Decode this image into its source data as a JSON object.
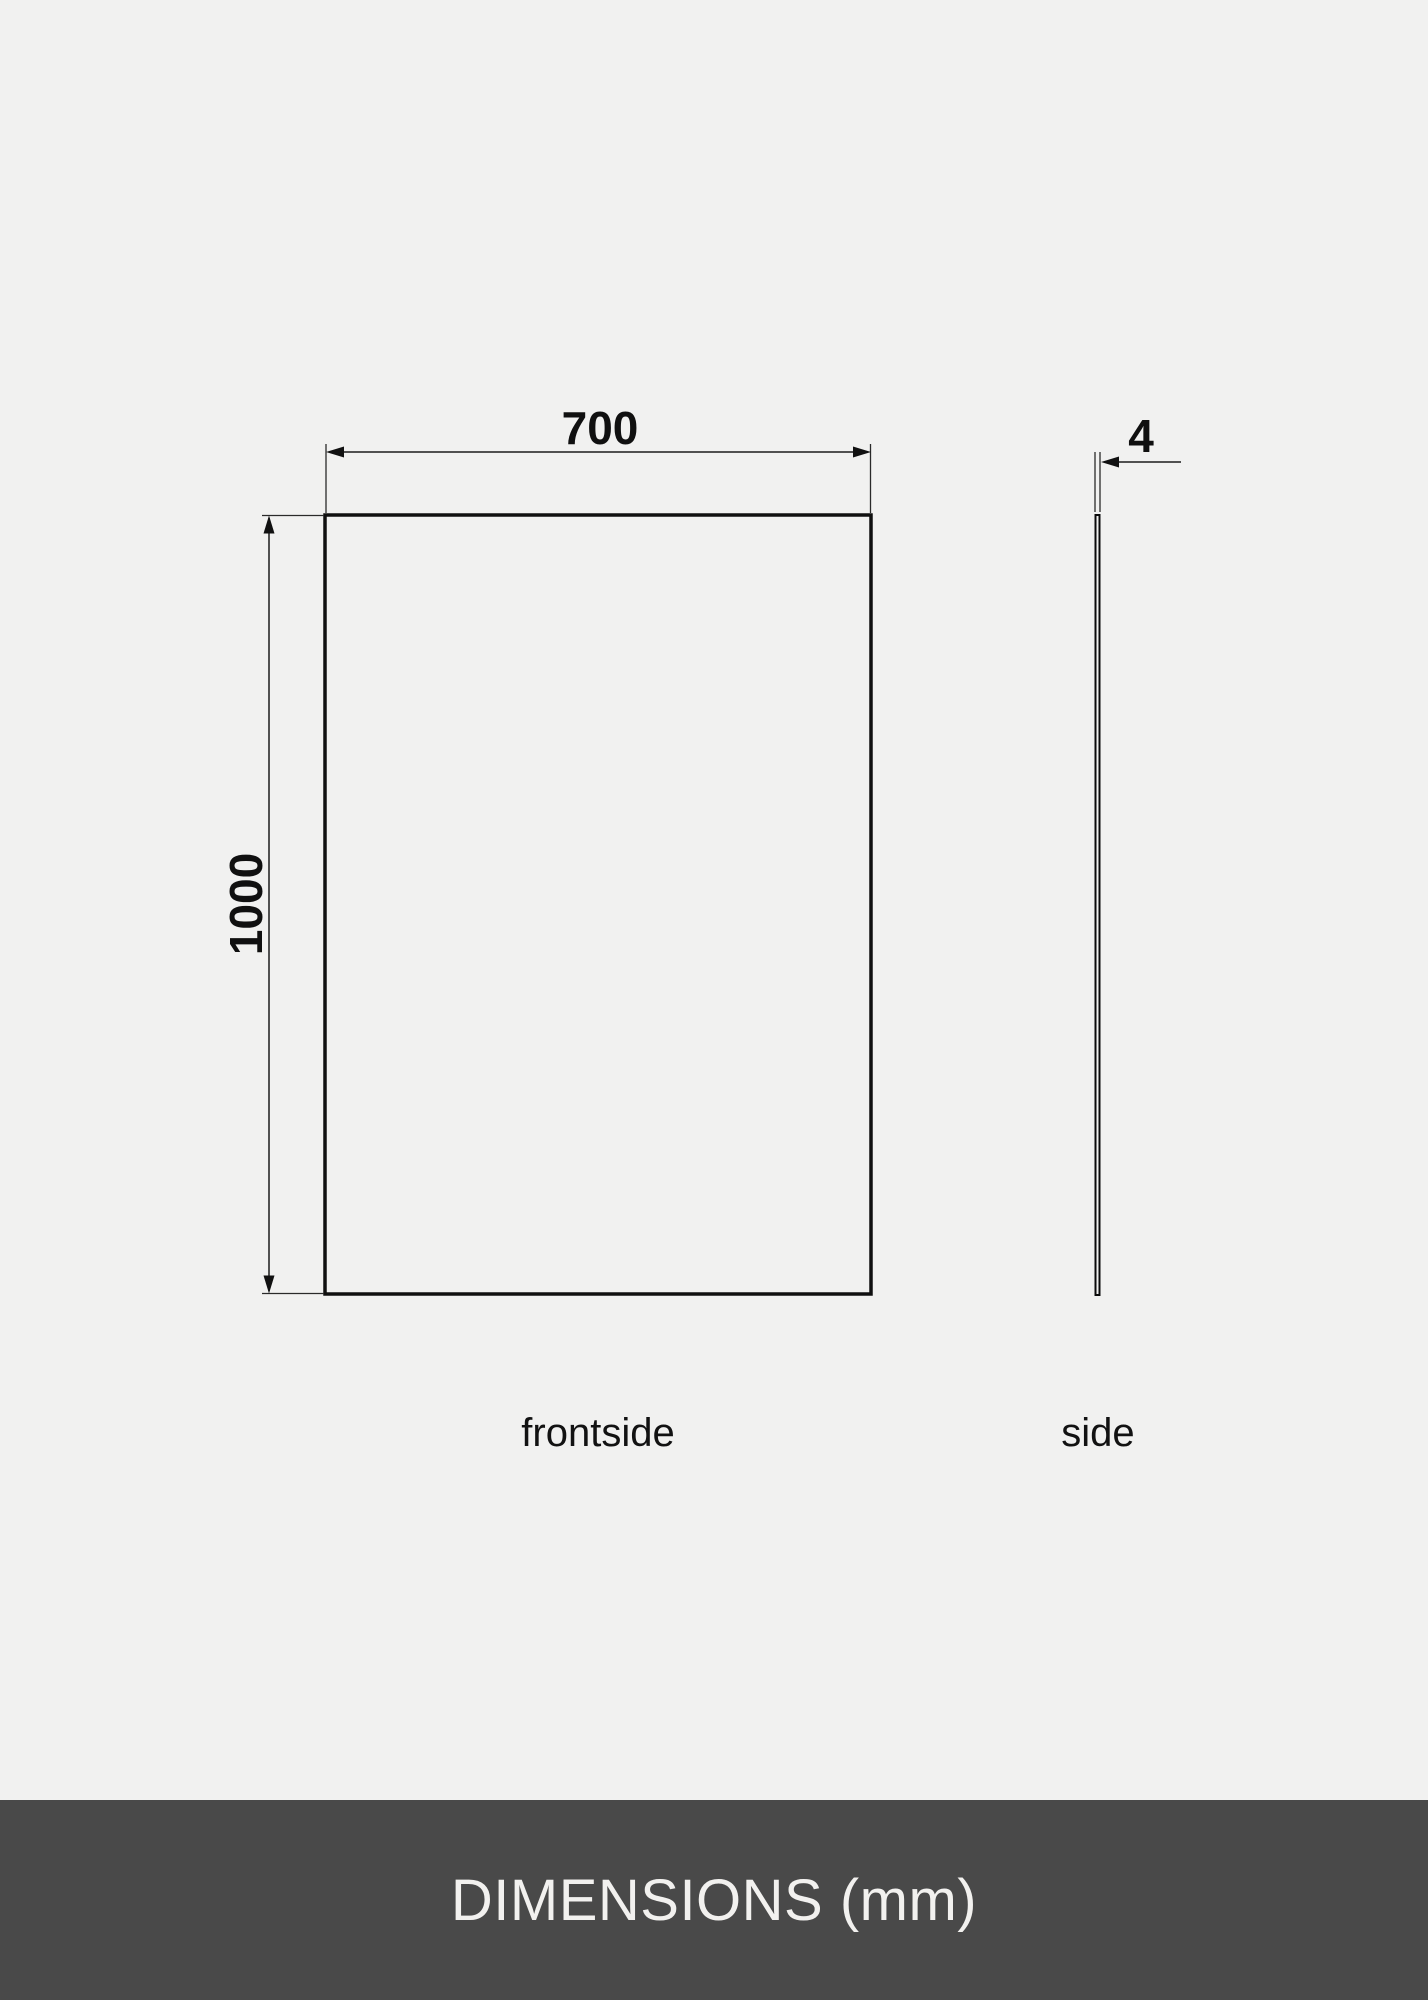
{
  "page": {
    "background_color": "#f1f1f0"
  },
  "diagram": {
    "front_view": {
      "width_mm": "700",
      "height_mm": "1000",
      "caption": "frontside"
    },
    "side_view": {
      "thickness_mm": "4",
      "caption": "side"
    },
    "line_color": "#101010"
  },
  "footer": {
    "title": "DIMENSIONS (mm)",
    "background_color": "#494949",
    "text_color": "#f2f1ef"
  }
}
